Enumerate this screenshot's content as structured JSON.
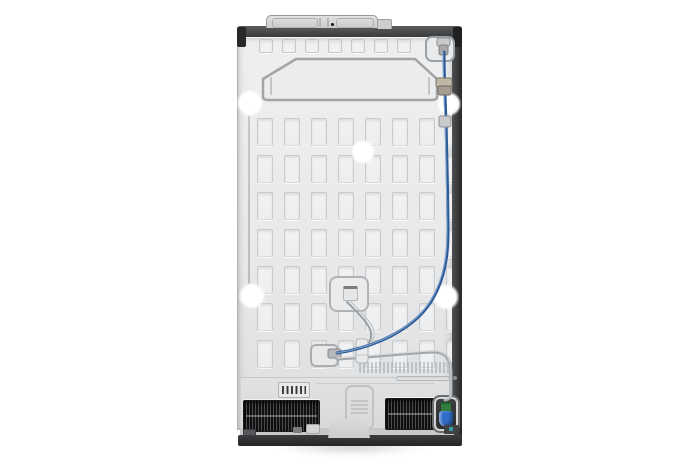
{
  "meta": {
    "description": "Product photo: rear view of a side-by-side refrigerator on a white background",
    "subject": "refrigerator-back",
    "visible_text": "none (stamped embossing illegible)"
  },
  "colors": {
    "background": "#ffffff",
    "panel_light": "#edeff1",
    "panel_dark": "#dcdee0",
    "panel_edge": "#b0b2b4",
    "slot_fill": "#f0f2f4",
    "slot_border": "#c8cacc",
    "top_strip_light": "#595b5d",
    "top_strip_dark": "#393b3d",
    "side_light": "#4e5052",
    "side_dark": "#26282a",
    "base_light": "#3a3c3e",
    "base_dark": "#232527",
    "grille_bg": "#0e0f10",
    "grille_rib": "#4a4c4e",
    "water_line_blue": "#2d5b97",
    "water_line_highlight": "#8fb2d8",
    "tube_gray": "#a4a7a9",
    "valve_green": "#2f7c3c",
    "valve_blue": "#2f6cc8",
    "clip_tan": "#c0b6a6",
    "emboss_line": "#a2a4a6",
    "hole_white": "#ffffff"
  },
  "panel": {
    "origin": {
      "x": 237,
      "y": 36
    },
    "slot_grid": {
      "x0": 256,
      "y0": 118,
      "cols": 8,
      "rows": 7,
      "pitch_x": 27,
      "pitch_y": 37,
      "slot_w": 16,
      "slot_h": 28
    },
    "top_vents": {
      "x0": 258,
      "y0": 39,
      "count": 7,
      "pitch": 23,
      "size": 14
    },
    "screw_holes": [
      {
        "cx": 250,
        "cy": 103,
        "r": 11
      },
      {
        "cx": 449,
        "cy": 104,
        "r": 10
      },
      {
        "cx": 363,
        "cy": 152,
        "r": 10
      },
      {
        "cx": 252,
        "cy": 296,
        "r": 11
      },
      {
        "cx": 446,
        "cy": 297,
        "r": 11
      }
    ]
  },
  "tubes": {
    "water_line": "M 444,52 C 444,72 445,96 446,122 C 447,162 448,204 448,234 C 448,264 441,288 428,306 C 412,328 378,347 337,353",
    "capillary": "M 347,302 C 358,313 370,324 371,333 C 372,342 365,349 360,353",
    "drain": "M 337,359 C 372,357 420,352 434,352 C 447,352 451,361 451,372 L 451,393 C 451,398 448,400 445,400",
    "octagon": "M 263,97 L 263,79 L 296,59 L 415,59 L 437,79 L 437,97 Q 437,100 431,100 L 269,100 Q 263,100 263,97 Z",
    "octagon_brackets": "M 271,78 L 271,94 M 429,78 L 429,94"
  }
}
